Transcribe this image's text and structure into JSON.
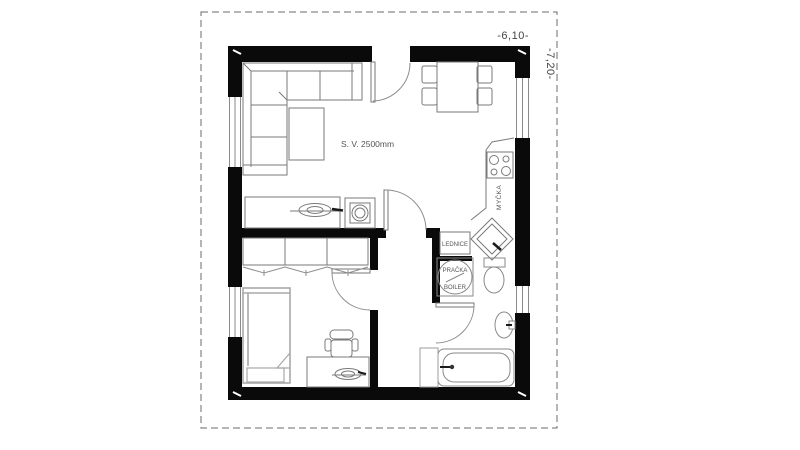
{
  "floorplan": {
    "dimensions": {
      "width_label": "-6,10-",
      "height_label": "-7,20-"
    },
    "annotations": {
      "ceiling_height": "S. V. 2500mm"
    },
    "appliance_labels": {
      "dishwasher": "MYČKA",
      "fridge": "LEDNICE",
      "washing_machine": "PRAČKA",
      "boiler": "BOILER"
    },
    "colors": {
      "walls": "#0a0a0a",
      "furniture_outline": "#7a7a7a",
      "bed_outline": "#a8a8a8",
      "boundary_dash": "#6b6b6b",
      "background": "#ffffff"
    }
  }
}
